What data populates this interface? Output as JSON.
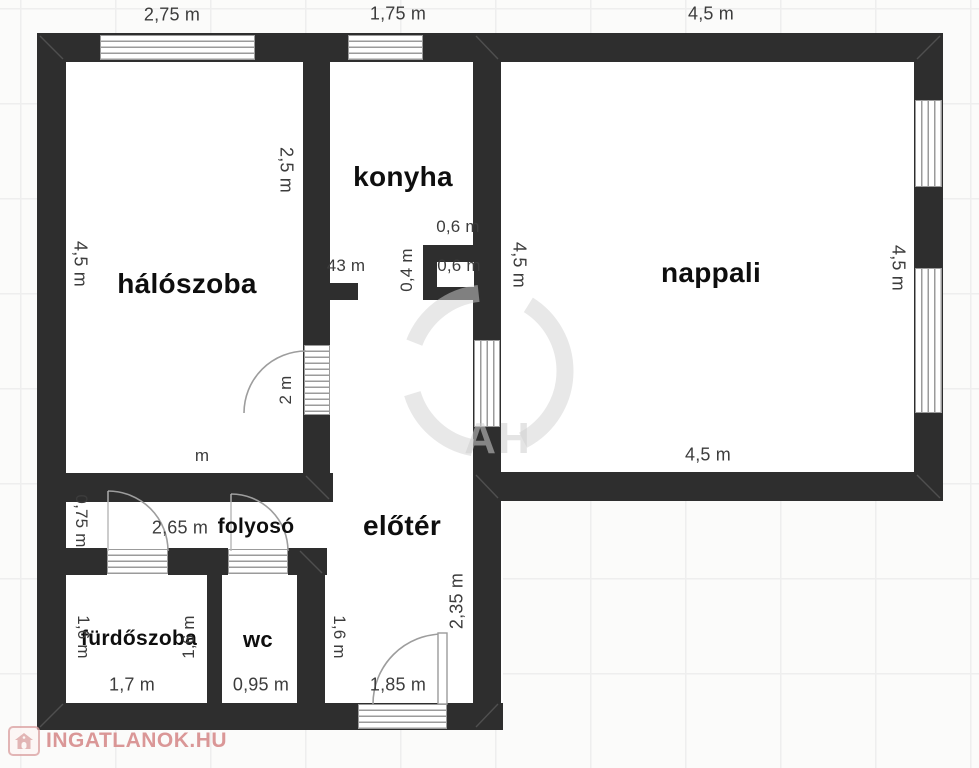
{
  "rooms": {
    "haloszoba": "hálószoba",
    "konyha": "konyha",
    "nappali": "nappali",
    "eloter": "előtér",
    "folyoso": "folyosó",
    "furdoszoba": "fürdőszoba",
    "wc": "wc"
  },
  "dimensions": {
    "halo_top": "2,75 m",
    "konyha_top": "1,75 m",
    "nappali_top": "4,5 m",
    "halo_left": "4,5 m",
    "konyha_left_wall": "2,5 m",
    "konyha_width_partial": "43 m",
    "shaft_top": "0,6 m",
    "shaft_inner": "0,6 m",
    "shaft_left": "0,4 m",
    "nappali_left": "4,5 m",
    "nappali_right": "4,5 m",
    "nappali_bottom": "4,5 m",
    "halo_door": "2 m",
    "halo_bottom_partial": "m",
    "folyoso_left": "0,75 m",
    "folyoso_width": "2,65 m",
    "furdo_left": "1,6 m",
    "furdo_right": "1,6 m",
    "furdo_width": "1,7 m",
    "wc_width": "0,95 m",
    "eloter_left": "1,6 m",
    "eloter_right": "2,35 m",
    "entry_door": "1,85 m"
  },
  "branding": {
    "footer_site": "INGATLANOK.HU",
    "center_mark": "AH",
    "house_icon": "house-icon"
  },
  "colors": {
    "wall": "#2e2e2e",
    "dim_text": "#3c3c3c",
    "brand_red": "#d37f7f",
    "watermark_gray": "#cfcfcf"
  }
}
